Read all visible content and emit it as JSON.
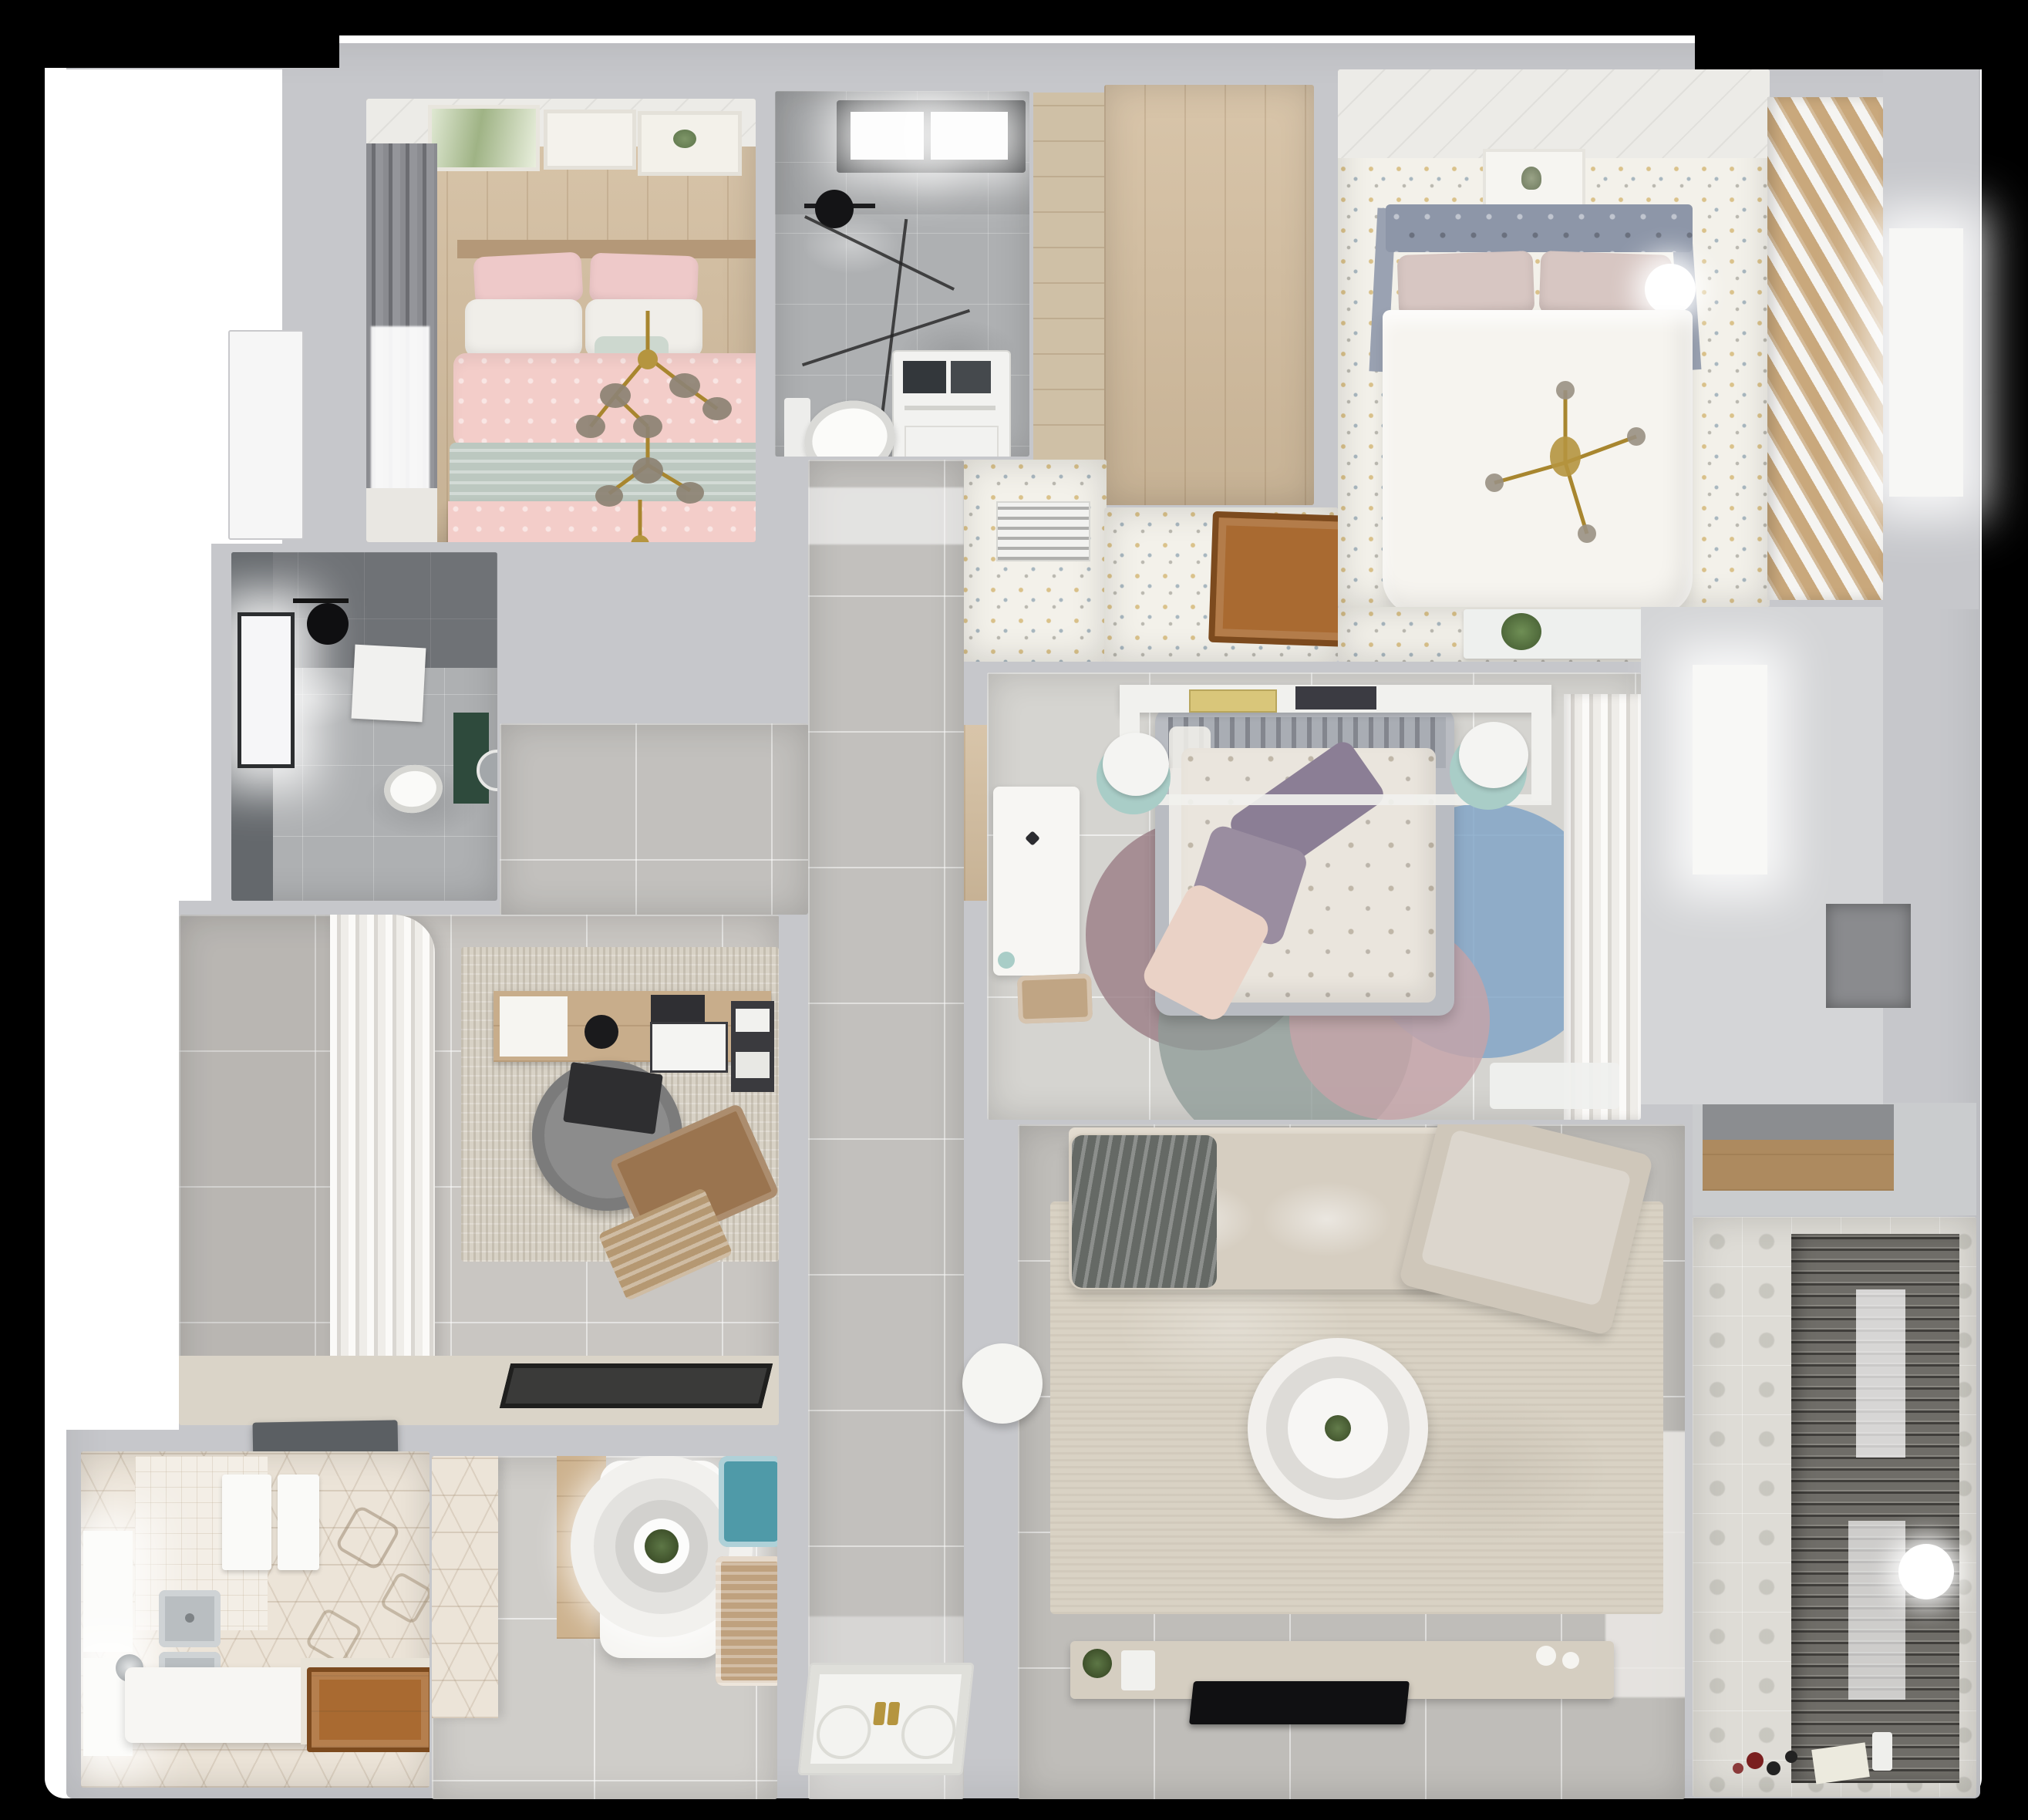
{
  "scene": {
    "type": "3d-floorplan-top-down-render",
    "background": "#000000"
  },
  "palette": {
    "bg": "#000000",
    "plate": "#ffffff",
    "wall": "#c6c7cb",
    "wallbright": "#dcdcdf",
    "pink": "#f3cdc9",
    "sage": "#bcc8c0",
    "linen": "#f0eee9",
    "steel": "#8d96a8",
    "blush": "#d7c6c2",
    "duvet": "#f6f4ef",
    "purple": "#8b7e95",
    "mauve": "#9a8da0",
    "peach": "#ead2c6",
    "duvet2": "#eae5dd",
    "mint": "#a9cdc7",
    "teal": "#4f9aa8",
    "rattan": "#bfa17e",
    "darkwall": "#6f7276",
    "greenmat": "#2e4a3c",
    "deskwood": "#c8ad8b",
    "chairgray": "#8c8c8c",
    "lounge": "#9a744f",
    "matblack": "#3a3a39",
    "steelsink": "#b9bec1",
    "hood": "#5b5f63",
    "wooddark": "#a96a31",
    "tablewhite": "#f6f5f2",
    "sofa": "#d6cec1",
    "throw": "#656965",
    "ruglive": "#d9d2c4",
    "console": "#d5cec1",
    "tv": "#101012",
    "shelfwood": "#ad8a5f",
    "gold": "#b5953f",
    "orb": "#8d8374",
    "plant": "#4d6b3c",
    "rugmauve": "rgba(155,127,134,0.82)",
    "rugsteel": "rgba(143,156,153,0.78)",
    "rugblue": "rgba(127,163,198,0.82)",
    "rugpink": "rgba(196,163,168,0.82)"
  },
  "rooms": [
    {
      "id": "bedroom-pink",
      "name": "pink bedroom",
      "furniture": [
        "art-frames",
        "dark-drapes",
        "window",
        "double-bed-pink-sage",
        "gold-chandeliers",
        "foot-bench"
      ]
    },
    {
      "id": "bathroom-top",
      "name": "bathroom 1",
      "furniture": [
        "black-framed-window",
        "rain-shower",
        "glass-screen",
        "washer-unit",
        "toilet"
      ]
    },
    {
      "id": "hall-nook",
      "name": "wood-floor nook",
      "furniture": []
    },
    {
      "id": "master-bedroom",
      "name": "master bedroom",
      "furniture": [
        "ceiling-trim",
        "art-frame",
        "tufted-headboard",
        "pillows",
        "sphere-lamp",
        "white-duvet-bed",
        "gold-cross-chandelier",
        "slatted-wardrobe"
      ]
    },
    {
      "id": "inner-hall",
      "name": "inner hall",
      "furniture": [
        "ac-vent",
        "wood-floor-hatch",
        "plant-console"
      ]
    },
    {
      "id": "bedroom-2",
      "name": "bedroom 2",
      "furniture": [
        "bridge-shelf-books",
        "round-stools",
        "gray-frame-bed",
        "floral-duvet",
        "purple-pillows",
        "circle-rug",
        "white-desk",
        "desk-chair",
        "curtain-wardrobe",
        "floor-mat"
      ]
    },
    {
      "id": "bathroom-dark",
      "name": "bathroom 2",
      "furniture": [
        "window",
        "rain-shower",
        "towel",
        "toilet",
        "green-mat",
        "round-mirror"
      ]
    },
    {
      "id": "study",
      "name": "study",
      "furniture": [
        "curtain-wardrobe",
        "area-rug",
        "wood-desk",
        "desk-lamp",
        "monitor",
        "office-chair",
        "lounge-chair",
        "laptop-tray",
        "black-doormat"
      ]
    },
    {
      "id": "kitchen",
      "name": "kitchen",
      "furniture": [
        "range-hood",
        "double-steel-sink",
        "cutting-boards",
        "windows",
        "island-tub",
        "faucet",
        "wood-door",
        "hex-tile-floor"
      ]
    },
    {
      "id": "dining",
      "name": "dining area",
      "furniture": [
        "hex-accent-wall",
        "sideboard",
        "white-table",
        "ring-pendant-lamp",
        "teal-chair",
        "rattan-chair"
      ]
    },
    {
      "id": "corridor",
      "name": "corridor",
      "furniture": []
    },
    {
      "id": "living",
      "name": "living room",
      "furniture": [
        "sectional-sofa",
        "gray-throw",
        "chaise",
        "beige-rug",
        "round-coffee-table",
        "side-table",
        "tv-console",
        "flat-tv",
        "decor-plants"
      ]
    },
    {
      "id": "balcony",
      "name": "balcony",
      "furniture": [
        "roller-blinds",
        "sphere-lamp",
        "patterned-tiles",
        "toys",
        "shelf-niche"
      ]
    },
    {
      "id": "entry",
      "name": "entry",
      "furniture": [
        "door-panel-gold-handles"
      ]
    }
  ]
}
